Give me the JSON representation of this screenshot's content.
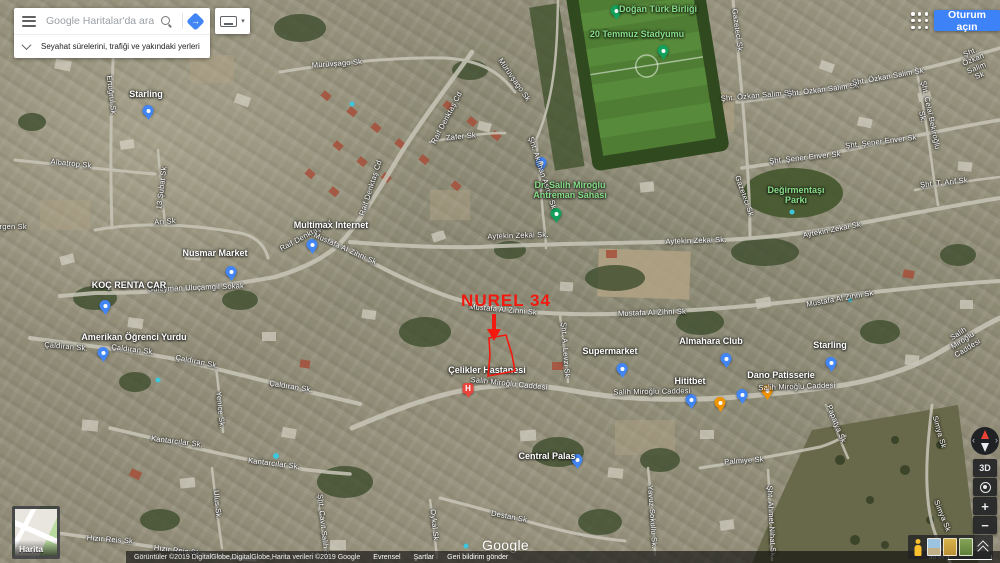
{
  "topbar": {
    "search_placeholder": "Google Haritalar'da ara",
    "travel_hint": "Seyahat sürelerini, trafiği ve yakındaki yerleri gör",
    "signin_label": "Oturum açın",
    "directions_icon": "diamond-arrow",
    "keyboard_icon": "keyboard"
  },
  "annotation": {
    "label": "NUREL 34"
  },
  "map": {
    "watermark": "Google",
    "minimap_label": "Harita",
    "controls": {
      "threed_label": "3D",
      "zoom_in": "+",
      "zoom_out": "−"
    },
    "labels": [
      {
        "t": "Mürüvşago Sk",
        "x": 337,
        "y": 64,
        "r": -4,
        "c": "s"
      },
      {
        "t": "Mürüvşago Sk",
        "x": 514,
        "y": 80,
        "r": 55,
        "c": "s"
      },
      {
        "t": "Raif Denktaş Cd",
        "x": 447,
        "y": 118,
        "r": -62,
        "c": "s"
      },
      {
        "t": "Raif Denktaş Cd",
        "x": 371,
        "y": 188,
        "r": -72,
        "c": "s"
      },
      {
        "t": "Raif Denktaş Cd",
        "x": 306,
        "y": 236,
        "r": -28,
        "c": "s"
      },
      {
        "t": "Zafer Sk",
        "x": 461,
        "y": 137,
        "r": -6,
        "c": "s"
      },
      {
        "t": "Arı Sk",
        "x": 165,
        "y": 222,
        "r": -4,
        "c": "s"
      },
      {
        "t": "Albatrop Sk",
        "x": 71,
        "y": 164,
        "r": 6,
        "c": "s"
      },
      {
        "t": "13 Şubat Sk",
        "x": 162,
        "y": 188,
        "r": -83,
        "c": "s"
      },
      {
        "t": "Ertuğrul Sk",
        "x": 111,
        "y": 95,
        "r": 83,
        "c": "s"
      },
      {
        "t": "Gürgen Sk",
        "x": 8,
        "y": 227,
        "r": 0,
        "c": "s"
      },
      {
        "t": "Süleyman Uluçamgil Sokak",
        "x": 196,
        "y": 288,
        "r": -2,
        "c": "s"
      },
      {
        "t": "Mustafa Al Zihni Sk",
        "x": 345,
        "y": 249,
        "r": 24,
        "c": "s"
      },
      {
        "t": "Mustafa Al Zihni Sk",
        "x": 503,
        "y": 310,
        "r": 5,
        "c": "s"
      },
      {
        "t": "Mustafa Al Zihni Sk",
        "x": 652,
        "y": 313,
        "r": -2,
        "c": "s"
      },
      {
        "t": "Mustafa Al Zihni Sk",
        "x": 840,
        "y": 299,
        "r": -10,
        "c": "s"
      },
      {
        "t": "Aytekin Zekai Sk.",
        "x": 518,
        "y": 236,
        "r": -2,
        "c": "s"
      },
      {
        "t": "Aytekin Zekai Sk.",
        "x": 696,
        "y": 241,
        "r": -2,
        "c": "s"
      },
      {
        "t": "Aytekin Zekai Sk.",
        "x": 833,
        "y": 230,
        "r": -11,
        "c": "s"
      },
      {
        "t": "Çaldıran Sk.",
        "x": 66,
        "y": 347,
        "r": 5,
        "c": "s"
      },
      {
        "t": "Çaldıran Sk.",
        "x": 133,
        "y": 350,
        "r": 7,
        "c": "s"
      },
      {
        "t": "Çaldıran Sk.",
        "x": 197,
        "y": 362,
        "r": 11,
        "c": "s"
      },
      {
        "t": "Çaldıran Sk.",
        "x": 291,
        "y": 387,
        "r": 9,
        "c": "s"
      },
      {
        "t": "Yenice Sk.",
        "x": 220,
        "y": 410,
        "r": 84,
        "c": "s"
      },
      {
        "t": "Kantarcılar Sk.",
        "x": 177,
        "y": 442,
        "r": 7,
        "c": "s"
      },
      {
        "t": "Kantarcılar Sk.",
        "x": 274,
        "y": 464,
        "r": 7,
        "c": "s"
      },
      {
        "t": "Ulus Sk.",
        "x": 217,
        "y": 505,
        "r": 84,
        "c": "s"
      },
      {
        "t": "Hızır Reis Sk.",
        "x": 111,
        "y": 540,
        "r": 4,
        "c": "s"
      },
      {
        "t": "Hızır Reis Sk.",
        "x": 178,
        "y": 551,
        "r": 7,
        "c": "s"
      },
      {
        "t": "Şht. Cavit Salih Sk",
        "x": 323,
        "y": 527,
        "r": 84,
        "c": "s"
      },
      {
        "t": "Salih Miroğlu Caddesi",
        "x": 509,
        "y": 384,
        "r": 6,
        "c": "s"
      },
      {
        "t": "Salih Miroğlu Caddesi",
        "x": 652,
        "y": 392,
        "r": -1,
        "c": "s"
      },
      {
        "t": "Salih Miroğlu Caddesi",
        "x": 797,
        "y": 387,
        "r": -2,
        "c": "s"
      },
      {
        "t": "Salih Miroğlu Caddesi",
        "x": 963,
        "y": 341,
        "r": -32,
        "c": "s"
      },
      {
        "t": "Destan Sk",
        "x": 509,
        "y": 517,
        "r": 11,
        "c": "s"
      },
      {
        "t": "Yavuz Sokullu Sk.",
        "x": 652,
        "y": 517,
        "r": 86,
        "c": "s"
      },
      {
        "t": "Palmiye Sk",
        "x": 744,
        "y": 461,
        "r": -4,
        "c": "s"
      },
      {
        "t": "Şht. Ahmet Nihat Sk",
        "x": 771,
        "y": 521,
        "r": 87,
        "c": "s"
      },
      {
        "t": "Papatya Sk",
        "x": 836,
        "y": 424,
        "r": 68,
        "c": "s"
      },
      {
        "t": "Simya Sk",
        "x": 939,
        "y": 432,
        "r": 74,
        "c": "s"
      },
      {
        "t": "Simya Sk",
        "x": 942,
        "y": 516,
        "r": 68,
        "c": "s"
      },
      {
        "t": "Şht. Özkan Salim Sk",
        "x": 757,
        "y": 96,
        "r": -5,
        "c": "s"
      },
      {
        "t": "Şht. Özkan Salim Sk",
        "x": 823,
        "y": 90,
        "r": -7,
        "c": "s"
      },
      {
        "t": "Şht. Özkan Salim Sk",
        "x": 888,
        "y": 77,
        "r": -10,
        "c": "s"
      },
      {
        "t": "Şht. Özkan Salim Sk",
        "x": 975,
        "y": 64,
        "r": -22,
        "c": "s"
      },
      {
        "t": "Şht. Şener Enver Sk",
        "x": 805,
        "y": 158,
        "r": -6,
        "c": "s"
      },
      {
        "t": "Şht. Şener Enver Sk",
        "x": 881,
        "y": 142,
        "r": -7,
        "c": "s"
      },
      {
        "t": "Şht. Celal Bekiroğlu Sk.",
        "x": 926,
        "y": 116,
        "r": 78,
        "c": "s"
      },
      {
        "t": "Şht. T. Arif Sk",
        "x": 944,
        "y": 183,
        "r": -6,
        "c": "s"
      },
      {
        "t": "Gazeteci Sk",
        "x": 737,
        "y": 30,
        "r": 82,
        "c": "s"
      },
      {
        "t": "Gazeteci Sk",
        "x": 744,
        "y": 196,
        "r": 70,
        "c": "s"
      },
      {
        "t": "Şht. Akılhan Asma Sk",
        "x": 542,
        "y": 173,
        "r": 72,
        "c": "s"
      },
      {
        "t": "Şht. A. Levzi Sk",
        "x": 565,
        "y": 350,
        "r": 86,
        "c": "s"
      },
      {
        "t": "Oykal Sk",
        "x": 434,
        "y": 525,
        "r": 84,
        "c": "s"
      },
      {
        "t": "Starling",
        "x": 146,
        "y": 95,
        "r": 0,
        "c": "p"
      },
      {
        "t": "Nusmar Market",
        "x": 215,
        "y": 254,
        "r": 0,
        "c": "p"
      },
      {
        "t": "Multimax Internet",
        "x": 331,
        "y": 226,
        "r": 0,
        "c": "p"
      },
      {
        "t": "KOÇ RENTA CAR",
        "x": 129,
        "y": 286,
        "r": 0,
        "c": "p"
      },
      {
        "t": "Amerikan Öğrenci Yurdu",
        "x": 134,
        "y": 338,
        "r": 0,
        "c": "p"
      },
      {
        "t": "Çelikler Hastanesi",
        "x": 487,
        "y": 371,
        "r": 0,
        "c": "p"
      },
      {
        "t": "Supermarket",
        "x": 610,
        "y": 352,
        "r": 0,
        "c": "p"
      },
      {
        "t": "Almahara Club",
        "x": 711,
        "y": 342,
        "r": 0,
        "c": "p"
      },
      {
        "t": "Dano Patisserie",
        "x": 781,
        "y": 376,
        "r": 0,
        "c": "p"
      },
      {
        "t": "Starling",
        "x": 830,
        "y": 346,
        "r": 0,
        "c": "p"
      },
      {
        "t": "Hititbet",
        "x": 690,
        "y": 382,
        "r": 0,
        "c": "p"
      },
      {
        "t": "Central Palas",
        "x": 547,
        "y": 457,
        "r": 0,
        "c": "p"
      },
      {
        "t": "Doğan Türk Birliği",
        "x": 658,
        "y": 10,
        "r": 0,
        "c": "a"
      },
      {
        "t": "20 Temmuz Stadyumu",
        "x": 637,
        "y": 35,
        "r": 0,
        "c": "a"
      },
      {
        "t": "Dr. Salih Miroğlu\nAntreman Sahası",
        "x": 570,
        "y": 191,
        "r": 0,
        "c": "a"
      },
      {
        "t": "Değirmentaşı\nParkı",
        "x": 796,
        "y": 196,
        "r": 0,
        "c": "a"
      }
    ],
    "pins": [
      {
        "x": 148,
        "y": 116,
        "k": "default"
      },
      {
        "x": 231,
        "y": 277,
        "k": "shopping"
      },
      {
        "x": 312,
        "y": 250,
        "k": "default"
      },
      {
        "x": 105,
        "y": 311,
        "k": "default"
      },
      {
        "x": 103,
        "y": 358,
        "k": "default"
      },
      {
        "x": 541,
        "y": 168,
        "k": "default"
      },
      {
        "x": 468,
        "y": 394,
        "k": "hospital"
      },
      {
        "x": 622,
        "y": 374,
        "k": "shopping"
      },
      {
        "x": 726,
        "y": 364,
        "k": "default"
      },
      {
        "x": 767,
        "y": 396,
        "k": "food"
      },
      {
        "x": 831,
        "y": 368,
        "k": "default"
      },
      {
        "x": 691,
        "y": 405,
        "k": "default"
      },
      {
        "x": 720,
        "y": 408,
        "k": "food"
      },
      {
        "x": 742,
        "y": 400,
        "k": "shopping"
      },
      {
        "x": 577,
        "y": 465,
        "k": "default"
      },
      {
        "x": 616,
        "y": 16,
        "k": "park"
      },
      {
        "x": 663,
        "y": 56,
        "k": "park"
      },
      {
        "x": 556,
        "y": 219,
        "k": "park"
      }
    ]
  },
  "attribution": {
    "imagery": "Görüntüler ©2019 DigitalGlobe,DigitalGlobe,Harita verileri ©2019 Google",
    "links": [
      "Evrensel",
      "Şartlar",
      "Geri bildirim gönder"
    ],
    "scale": "50 m"
  },
  "colors": {
    "signin_blue": "#3e82f7",
    "accent_blue": "#4285f4",
    "annotation_red": "#f3190f",
    "pin_blue": "#4285f4",
    "pin_orange": "#f09300",
    "pin_red": "#e8453c",
    "pin_green": "#12a05a",
    "area_label_green": "#86dd86"
  }
}
